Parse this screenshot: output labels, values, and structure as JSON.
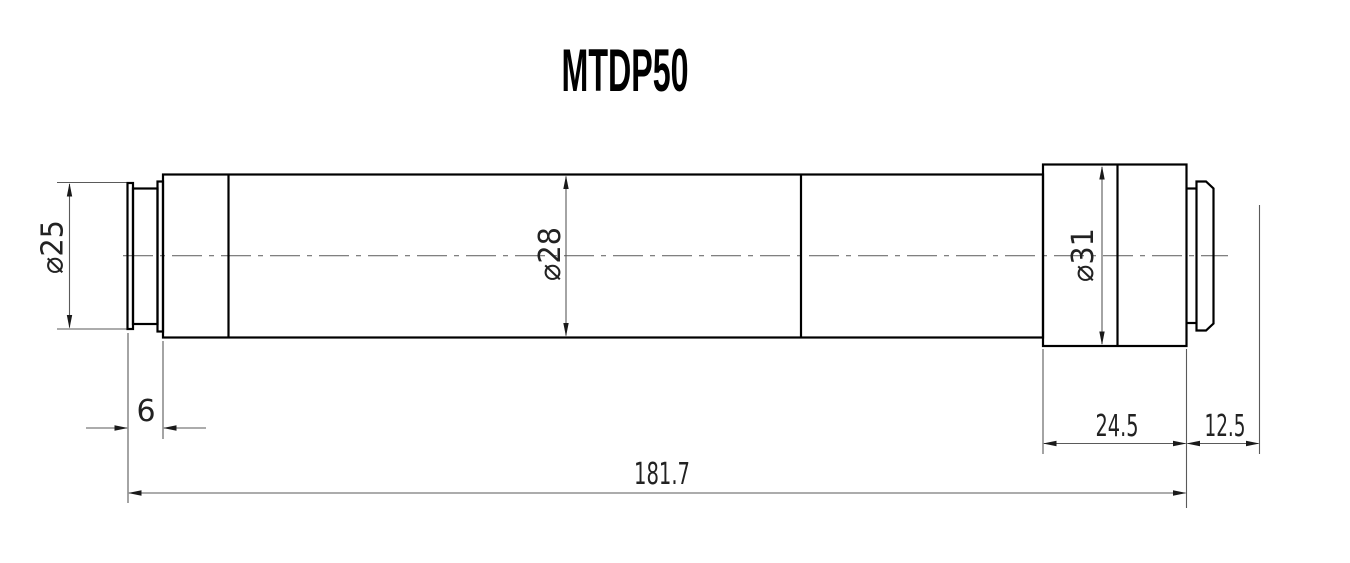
{
  "title": "MTDP50",
  "colors": {
    "background": "#ffffff",
    "outline": "#000000",
    "dimension_lines": "#5a5a5a",
    "centerline": "#6e6e6e",
    "text": "#222222"
  },
  "dimensions": {
    "front_diameter": "⌀25",
    "body_diameter": "⌀28",
    "rear_block_diameter": "⌀31",
    "front_flange_length": "6",
    "rear_block_length": "24.5",
    "rear_mount_length": "12.5",
    "overall_length": "181.7"
  }
}
